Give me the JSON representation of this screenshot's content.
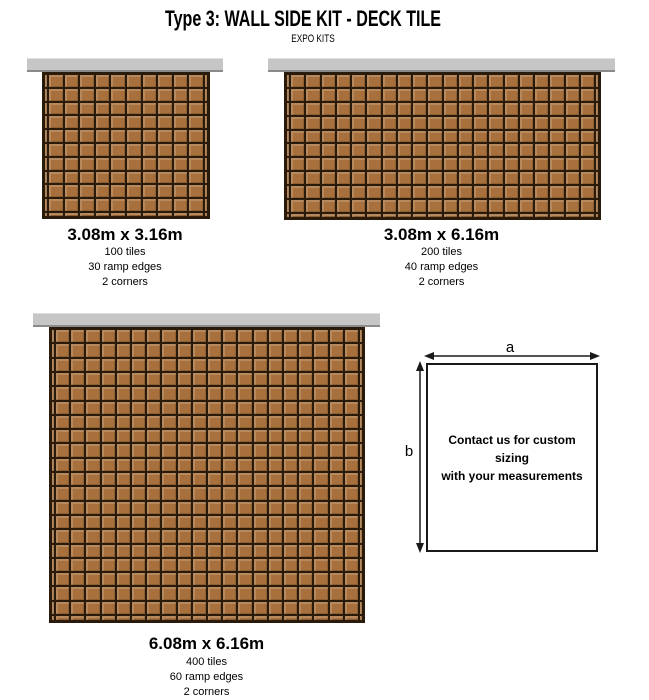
{
  "header": {
    "title": "Type 3: WALL SIDE KIT - DECK TILE",
    "subtitle": "EXPO KITS"
  },
  "kits": [
    {
      "dimensions_label": "3.08m x 3.16m",
      "stats": [
        "100 tiles",
        "30 ramp edges",
        "2 corners"
      ],
      "grid": {
        "cols": 10,
        "rows": 10
      }
    },
    {
      "dimensions_label": "3.08m x 6.16m",
      "stats": [
        "200 tiles",
        "40 ramp edges",
        "2 corners"
      ],
      "grid": {
        "cols": 20,
        "rows": 10
      }
    },
    {
      "dimensions_label": "6.08m x 6.16m",
      "stats": [
        "400 tiles",
        "60 ramp edges",
        "2 corners"
      ],
      "grid": {
        "cols": 20,
        "rows": 20
      }
    }
  ],
  "custom_sizing": {
    "width_label": "a",
    "height_label": "b",
    "message_lines": [
      "Contact us for custom sizing",
      "with your measurements"
    ]
  },
  "colors": {
    "tile_base": "#a7703c",
    "grid_line": "#2a1a0a",
    "wall_bar": "#c6c6c6",
    "wall_bar_edge": "#8b8b8b",
    "ink": "#1a1a1a"
  }
}
